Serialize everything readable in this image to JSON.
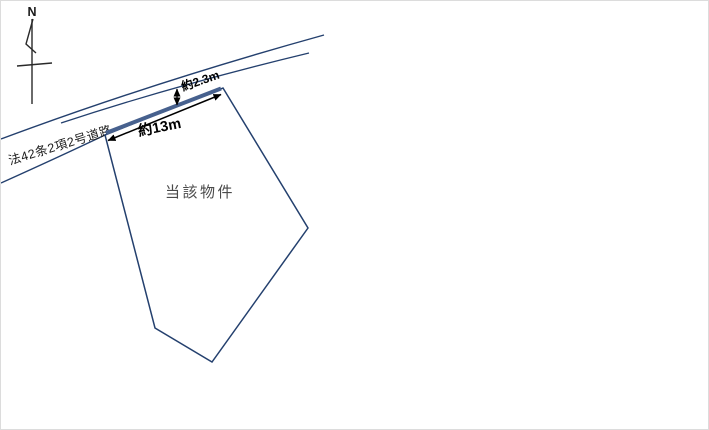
{
  "labels": {
    "north": "N",
    "road_name": "法42条2項2号道路",
    "frontage_dim": "約13m",
    "road_width_dim": "約2.3m",
    "parcel": "当該物件"
  },
  "colors": {
    "line_navy": "#24406e",
    "frontage_blue": "#47618e",
    "dimension_black": "#000000",
    "parcel_text_gray": "#4a4a4a",
    "road_text_black": "#1a1a1a",
    "background": "#ffffff"
  }
}
